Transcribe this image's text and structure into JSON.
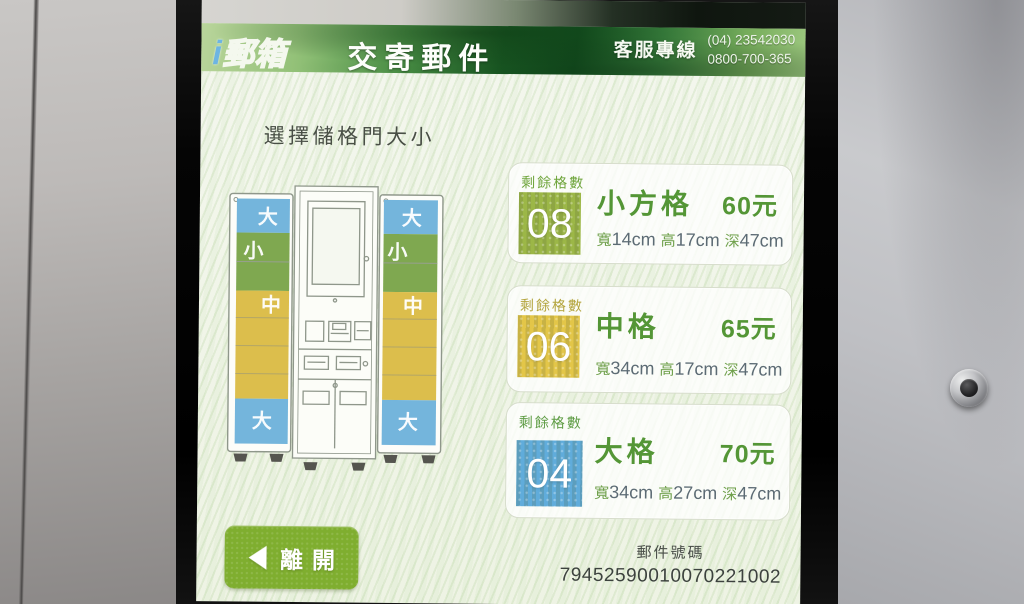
{
  "colors": {
    "header_green": "#2f7c33",
    "accent_green": "#549636",
    "button_green": "#7fae2f",
    "band_blue": "#74b5dc",
    "band_green": "#7fa850",
    "band_yellow": "#dcbe4c",
    "small_box": "#97b33d",
    "medium_box": "#e2c33e",
    "large_box": "#57a8d9"
  },
  "header": {
    "logo_i": "i",
    "logo_text": "郵箱",
    "title": "交寄郵件",
    "hotline_label": "客服專線",
    "hotline_numbers": [
      "(04) 23542030",
      "0800-700-365"
    ]
  },
  "main": {
    "heading": "選擇儲格門大小"
  },
  "diagram": {
    "left_labels": [
      "大",
      "小",
      "中",
      "大"
    ],
    "right_labels": [
      "大",
      "小",
      "中",
      "大"
    ]
  },
  "cards": [
    {
      "remaining_label": "剩餘格數",
      "count": "08",
      "name": "小方格",
      "price": "60元",
      "box_color": "#97b33d",
      "dims": [
        {
          "label": "寬",
          "value": "14cm"
        },
        {
          "label": "高",
          "value": "17cm"
        },
        {
          "label": "深",
          "value": "47cm"
        }
      ]
    },
    {
      "remaining_label": "剩餘格數",
      "count": "06",
      "name": "中格",
      "price": "65元",
      "box_color": "#e2c33e",
      "dims": [
        {
          "label": "寬",
          "value": "34cm"
        },
        {
          "label": "高",
          "value": "17cm"
        },
        {
          "label": "深",
          "value": "47cm"
        }
      ]
    },
    {
      "remaining_label": "剩餘格數",
      "count": "04",
      "name": "大格",
      "price": "70元",
      "box_color": "#57a8d9",
      "dims": [
        {
          "label": "寬",
          "value": "34cm"
        },
        {
          "label": "高",
          "value": "27cm"
        },
        {
          "label": "深",
          "value": "47cm"
        }
      ]
    }
  ],
  "footer": {
    "exit_label": "離開",
    "mail_number_label": "郵件號碼",
    "mail_number": "79452590010070221002"
  }
}
